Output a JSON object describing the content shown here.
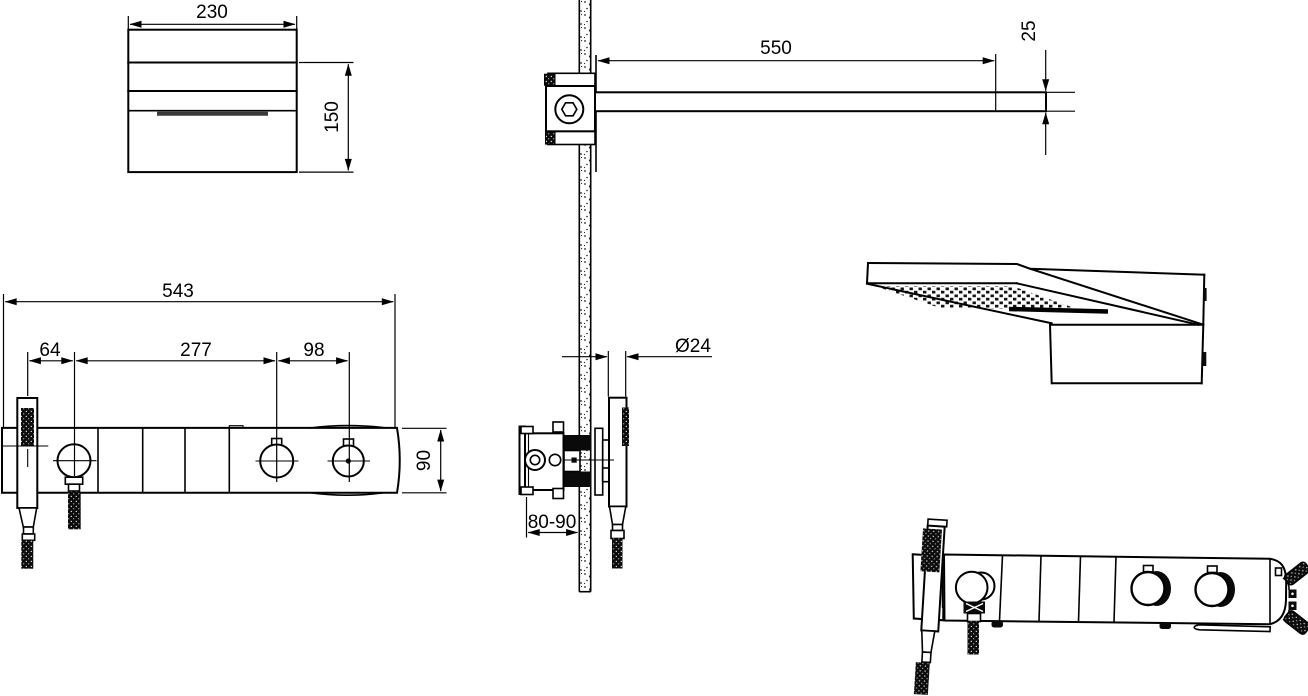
{
  "drawing": {
    "type": "shower-system-installation-drawing",
    "colors": {
      "line": "#000000",
      "background": "#ffffff"
    },
    "dimensions": {
      "head_top_view": {
        "width": "230",
        "depth": "150"
      },
      "arm_side_view": {
        "length": "550",
        "thickness": "25"
      },
      "panel_front_view": {
        "total_length": "543",
        "handshower_offset": "64",
        "knob_spacing": "277",
        "right_knob_spacing": "98",
        "height": "90"
      },
      "valve_side_view": {
        "wall_depth_range": "80-90",
        "handle_diameter": "Ø24"
      }
    }
  }
}
